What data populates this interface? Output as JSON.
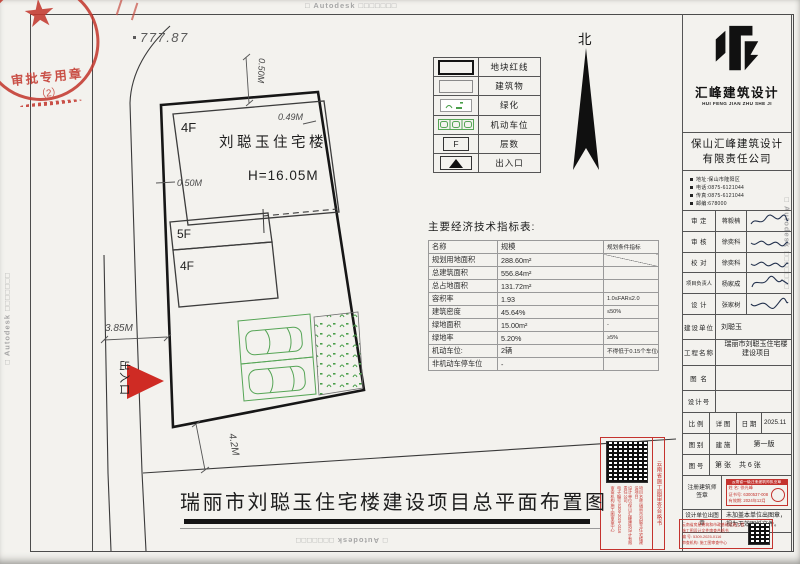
{
  "watermark": {
    "text": "□ Autodesk □□□□□□□"
  },
  "approval_stamp": {
    "title": "审批专用章",
    "number": "（2）"
  },
  "site_plan": {
    "spot_elevation": "777.87",
    "north_label": "北",
    "building_name": "刘聪玉住宅楼",
    "building_height": "H=16.05M",
    "floor_main": "4F",
    "floor_mid": "5F",
    "floor_low": "4F",
    "dim_top": "0.50M",
    "dim_top_right": "0.49M",
    "dim_left": "0.50M",
    "dim_road": "3.85M",
    "dim_south": "4.2M",
    "entrance_label": "出入口"
  },
  "legend": {
    "rows": [
      {
        "label": "地块红线"
      },
      {
        "label": "建筑物"
      },
      {
        "label": "绿化"
      },
      {
        "label": "机动车位"
      },
      {
        "label": "层数",
        "glyph": "F"
      },
      {
        "label": "出入口"
      }
    ]
  },
  "indicators": {
    "title": "主要经济技术指标表:",
    "headers": [
      "名称",
      "规模",
      "规划条件指标"
    ],
    "rows": [
      {
        "name": "规划用地面积",
        "value": "288.60m²",
        "cond": ""
      },
      {
        "name": "总建筑面积",
        "value": "556.84m²",
        "cond": ""
      },
      {
        "name": "总占地面积",
        "value": "131.72m²",
        "cond": ""
      },
      {
        "name": "容积率",
        "value": "1.93",
        "cond": "1.0≤FAR≤2.0"
      },
      {
        "name": "建筑密度",
        "value": "45.64%",
        "cond": "≤50%"
      },
      {
        "name": "绿地面积",
        "value": "15.00m²",
        "cond": "-"
      },
      {
        "name": "绿地率",
        "value": "5.20%",
        "cond": "≥5%"
      },
      {
        "name": "机动车位:",
        "value": "2辆",
        "cond": "不得低于0.15个车位/100m²"
      },
      {
        "name": "非机动车停车位",
        "value": "-",
        "cond": ""
      }
    ]
  },
  "title_block": {
    "logo_cn": "汇峰建筑设计",
    "logo_en": "HUI FENG JIAN ZHU SHE JI",
    "company_line1": "保山汇峰建筑设计",
    "company_line2": "有限责任公司",
    "contact": [
      {
        "text": "地址:保山市隆阳区"
      },
      {
        "text": "电话:0875-6121044"
      },
      {
        "text": "传真:0875-6121044"
      },
      {
        "text": "邮编:678000"
      }
    ],
    "signatures": [
      {
        "role": "审 定",
        "name": "蒋毅楠"
      },
      {
        "role": "审 核",
        "name": "徐奕科"
      },
      {
        "role": "校 对",
        "name": "徐奕科"
      },
      {
        "role": "项目负责人",
        "name": "杨家成"
      },
      {
        "role": "设 计",
        "name": "张家树"
      }
    ],
    "owner_label": "建设单位",
    "owner": "刘聪玉",
    "project_label": "工程名称",
    "project_line1": "瑞丽市刘聪玉住宅楼",
    "project_line2": "建设项目",
    "drawing_name_label": "图 名",
    "design_no_label": "设计号",
    "scale_label": "比 例",
    "scale_value": "详 图",
    "date_label": "日 期",
    "date_value": "2025.11",
    "category_label": "图 别",
    "category_value": "建 施",
    "edition": "第一版",
    "sheet_label": "图 号",
    "sheet_no": "第    张",
    "sheet_total": "共 6 张",
    "seal_label_1": "注册建筑师",
    "seal_label_2": "签章",
    "out_seal_label": "设计单位出图章",
    "out_seal_text_1": "未加盖本单位出图章，",
    "out_seal_text_2": "视为无效图纸文件。",
    "engineer_stamp": {
      "header": "云南省一级注册建筑师执业章",
      "name": "姓 名: 徐光峰",
      "cert": "证书号: 6300537-008",
      "valid": "有效期: 2024年12月"
    }
  },
  "certificates": {
    "vertical": {
      "title": "云南省施工图审查合格书",
      "cols": [
        {
          "text": "项目名称:瑞丽市刘聪玉住宅楼建设项目"
        },
        {
          "text": "设计单位:保山汇峰建筑设计有限责任公司"
        },
        {
          "text": "电子编号:5309-2025-0116"
        },
        {
          "text": "审查机构:施工图审查中心"
        }
      ]
    },
    "band": {
      "lines": [
        {
          "text": "云南省房屋建筑和市政基础设施工程"
        },
        {
          "text": "施工图设计文件审查合格书"
        },
        {
          "text": "编 号: 5309-2025-0116"
        },
        {
          "text": "审查机构: 施工图审查中心"
        }
      ]
    }
  },
  "bottom_title": "瑞丽市刘聪玉住宅楼建设项目总平面布置图"
}
